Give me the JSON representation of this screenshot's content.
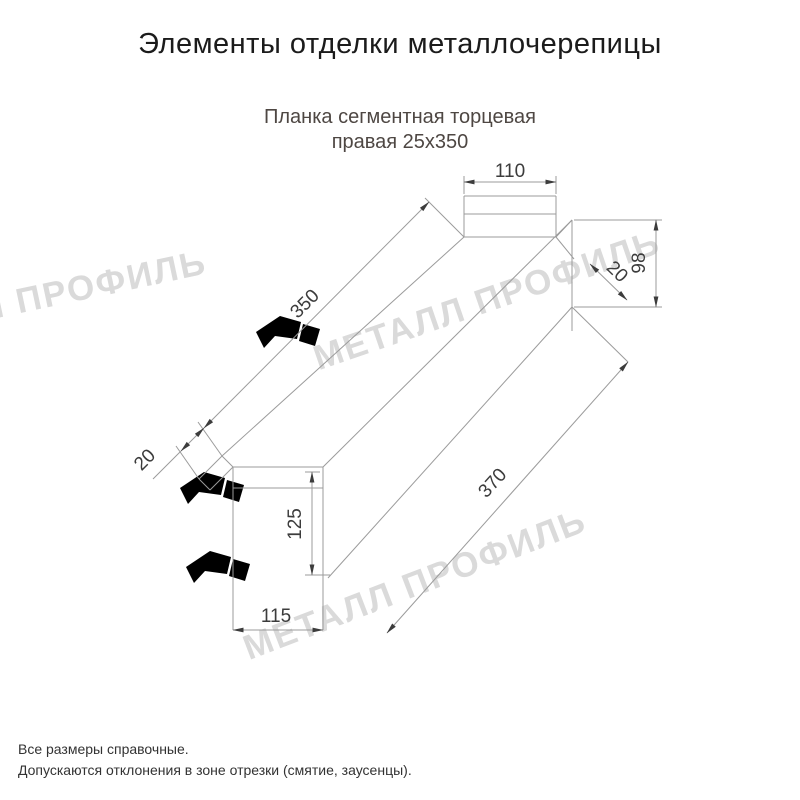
{
  "header": {
    "title": "Элементы отделки металлочерепицы"
  },
  "product": {
    "name_line1": "Планка сегментная торцевая",
    "name_line2": "правая 25х350"
  },
  "dimensions": {
    "top_tab_width": "110",
    "end_height": "98",
    "hem_right": "20",
    "top_edge_length": "350",
    "hem_left": "20",
    "face_height": "125",
    "bottom_edge_length": "370",
    "bottom_width": "115"
  },
  "watermark": {
    "text": "МЕТАЛЛ ПРОФИЛЬ"
  },
  "footer": {
    "note1": "Все размеры справочные.",
    "note2": "Допускаются отклонения в зоне отрезки (смятие, заусенцы)."
  },
  "colors": {
    "line": "#9b9b9b",
    "dimension_text": "#3c3c3c",
    "subtitle": "#4e4743",
    "watermark": "#dadada"
  }
}
